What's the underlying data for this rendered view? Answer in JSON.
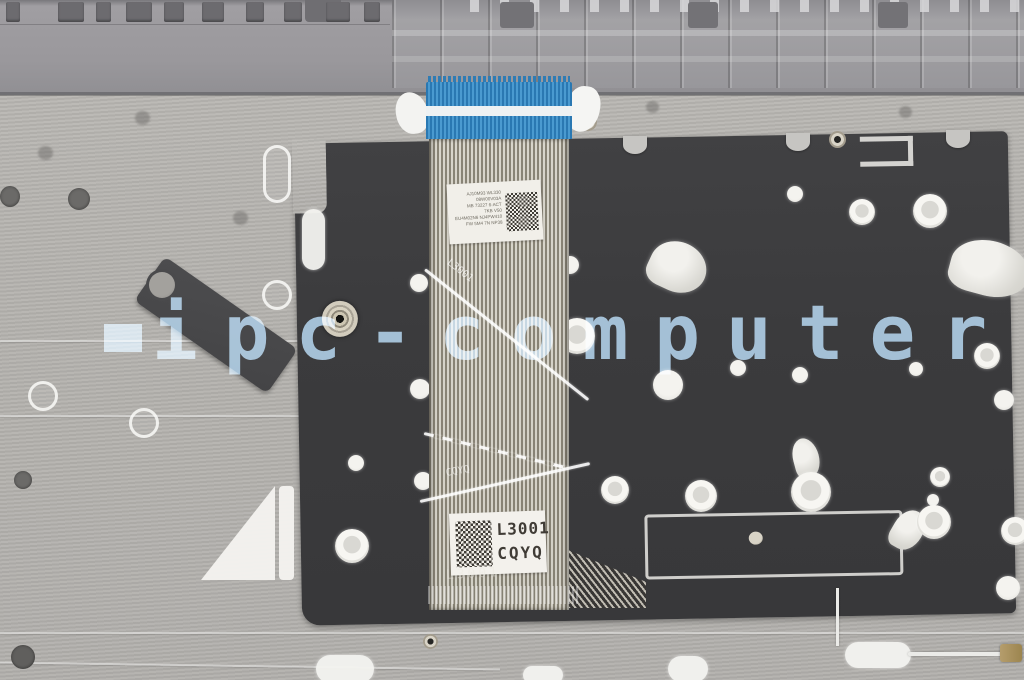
{
  "image": {
    "type": "product-photo",
    "subject": "laptop palmrest underside with keyboard ribbon cable",
    "watermark": {
      "text": "ipc-computer",
      "color": "#8fb6d4"
    },
    "labels": {
      "info_label": {
        "lines": [
          "AJ10M93 WL330 08W00V03A",
          "MB 73227 6-ACT",
          "7KB V50",
          "EU4M02N6 NJ4PW410",
          "FW 5M4 7N NP38"
        ]
      },
      "part_label": {
        "line1": "L3001",
        "line2": "CQYQ"
      }
    },
    "ghost_marks": {
      "mark1": "L3001",
      "mark2": "CQYQ",
      "mark3": "L3001"
    },
    "colors": {
      "connector_blue": "#3a8ec9",
      "plate_black": "#3b3b3d",
      "silver": "#b7b5b1",
      "plastic_gray": "#98979a",
      "cable_base": "#d6d3c9"
    }
  }
}
